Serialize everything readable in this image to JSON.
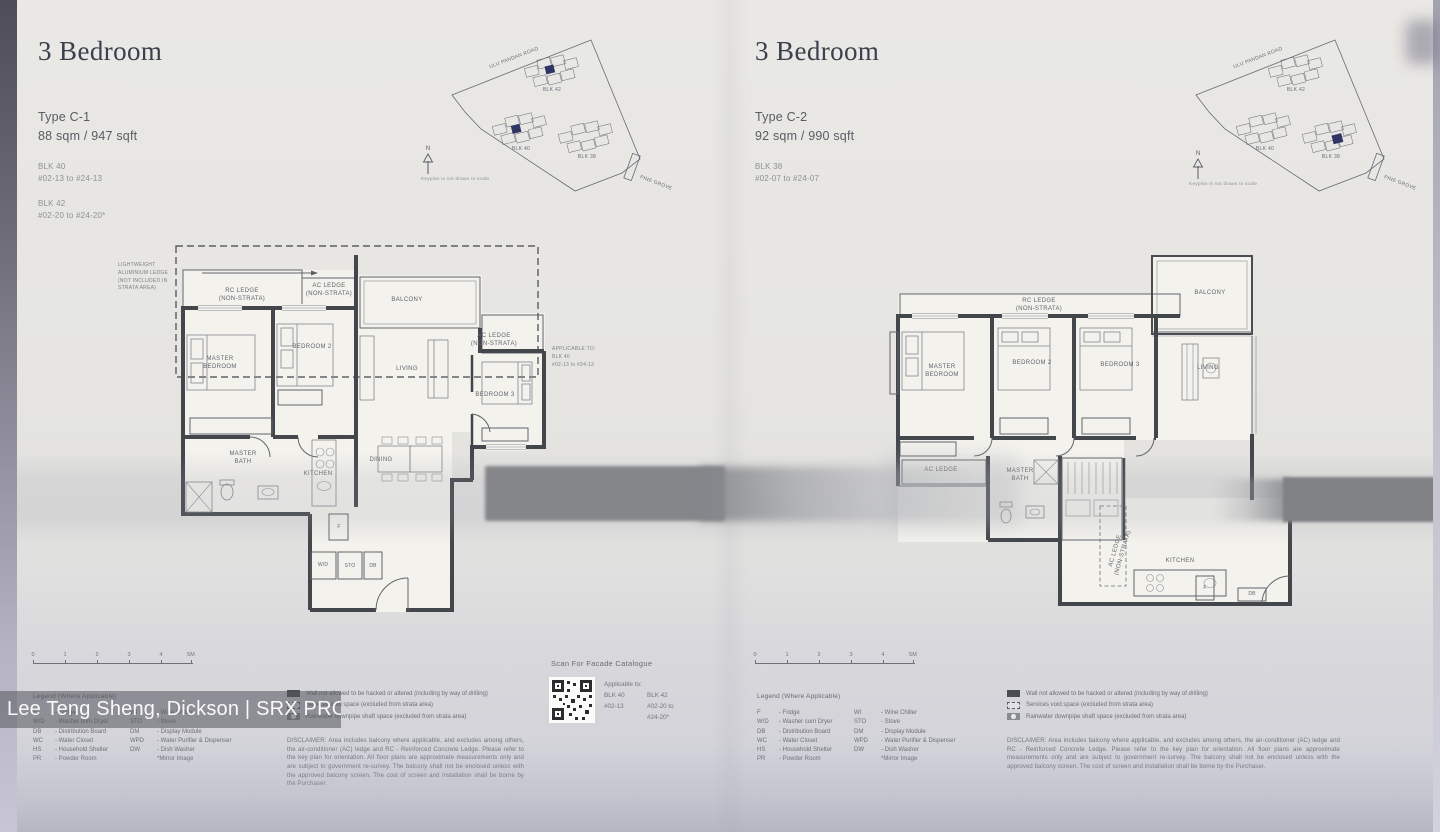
{
  "watermark": "Lee Teng Sheng, Dickson | SRX PROPERTY",
  "scale_ticks": [
    "0",
    "1",
    "2",
    "3",
    "4",
    "5M"
  ],
  "keyplan": {
    "road_top": "ULU PANDAN ROAD",
    "road_side": "PINE GROVE",
    "north": "N",
    "note": "Keyplan is not drawn to scale",
    "blk_top": "BLK 42",
    "blk_left": "BLK 40",
    "blk_right": "BLK 38"
  },
  "legend": {
    "title": "Legend (Where Applicable)",
    "col1": [
      {
        "abbr": "F",
        "desc": "- Fridge"
      },
      {
        "abbr": "W/D",
        "desc": "- Washer cum Dryer"
      },
      {
        "abbr": "DB",
        "desc": "- Distribution Board"
      },
      {
        "abbr": "WC",
        "desc": "- Water Closet"
      },
      {
        "abbr": "HS",
        "desc": "- Household Shelter"
      },
      {
        "abbr": "PR",
        "desc": "- Powder Room"
      }
    ],
    "col2": [
      {
        "abbr": "WI",
        "desc": "- Wine Chiller"
      },
      {
        "abbr": "STO",
        "desc": "- Stove"
      },
      {
        "abbr": "DM",
        "desc": "- Display Module"
      },
      {
        "abbr": "WPD",
        "desc": "- Water Purifier & Dispenser"
      },
      {
        "abbr": "DW",
        "desc": "- Dish Washer"
      },
      {
        "abbr": "",
        "desc": "*Mirror Image"
      }
    ]
  },
  "wall_legend": [
    "Wall not allowed to be hacked or altered (including by way of drilling)",
    "Services void space (excluded from strata area)",
    "Rainwater downpipe shaft space (excluded from strata area)"
  ],
  "disclaimer": "DISCLAIMER: Area includes balcony where applicable, and excludes among others, the air-conditioner (AC) ledge and RC - Reinforced Concrete Ledge. Please refer to the key plan for orientation. All floor plans are approximate measurements only and are subject to government re-survey. The balcony shall not be enclosed unless with the approved balcony screen. The cost of screen and installation shall be borne by the Purchaser.",
  "qr": {
    "title": "Scan For Facade Catalogue",
    "applicable_label": "Applicable to:",
    "col1_line1": "BLK 40",
    "col1_line2": "#02-13",
    "col2_line1": "BLK 42",
    "col2_line2": "#02-20 to",
    "col2_line3": "#24-20*"
  },
  "panels": [
    {
      "title": "3 Bedroom",
      "type_name": "Type C-1",
      "area": "88 sqm / 947 sqft",
      "stacks": [
        {
          "blk": "BLK 40",
          "range": "#02-13 to #24-13"
        },
        {
          "blk": "BLK 42",
          "range": "#02-20 to #24-20*"
        }
      ],
      "annotations": {
        "lightweight_ledge": "LIGHTWEIGHT\nALUMINIUM LEDGE\n(NOT INCLUDED IN\nSTRATA AREA)",
        "applicable": "APPLICABLE TO:\nBLK 40\n#02-13 to #24-13"
      },
      "rooms": {
        "rc_ledge": "RC LEDGE\n(NON-STRATA)",
        "ac_ledge_top": "AC LEDGE\n(NON-STRATA)",
        "balcony": "BALCONY",
        "master_bedroom": "MASTER\nBEDROOM",
        "bedroom2": "BEDROOM 2",
        "living": "LIVING",
        "ac_ledge_right": "AC LEDGE\n(NON-STRATA)",
        "bedroom3": "BEDROOM 3",
        "master_bath": "MASTER\nBATH",
        "kitchen": "KITCHEN",
        "dining": "DINING",
        "wd": "W/D",
        "sto": "STO",
        "db": "DB",
        "fridge": "F"
      }
    },
    {
      "title": "3 Bedroom",
      "type_name": "Type C-2",
      "area": "92 sqm / 990 sqft",
      "stacks": [
        {
          "blk": "BLK 38",
          "range": "#02-07 to #24-07"
        }
      ],
      "rooms": {
        "rc_ledge": "RC LEDGE\n(NON-STRATA)",
        "balcony": "BALCONY",
        "master_bedroom": "MASTER\nBEDROOM",
        "bedroom2": "BEDROOM 2",
        "bedroom3": "BEDROOM 3",
        "living": "LIVING",
        "ac_ledge": "AC LEDGE",
        "master_bath": "MASTER\nBATH",
        "ac_ledge_vert": "AC LEDGE\n(NON-STRATA)",
        "kitchen": "KITCHEN",
        "fridge": "F",
        "db": "DB"
      }
    }
  ]
}
